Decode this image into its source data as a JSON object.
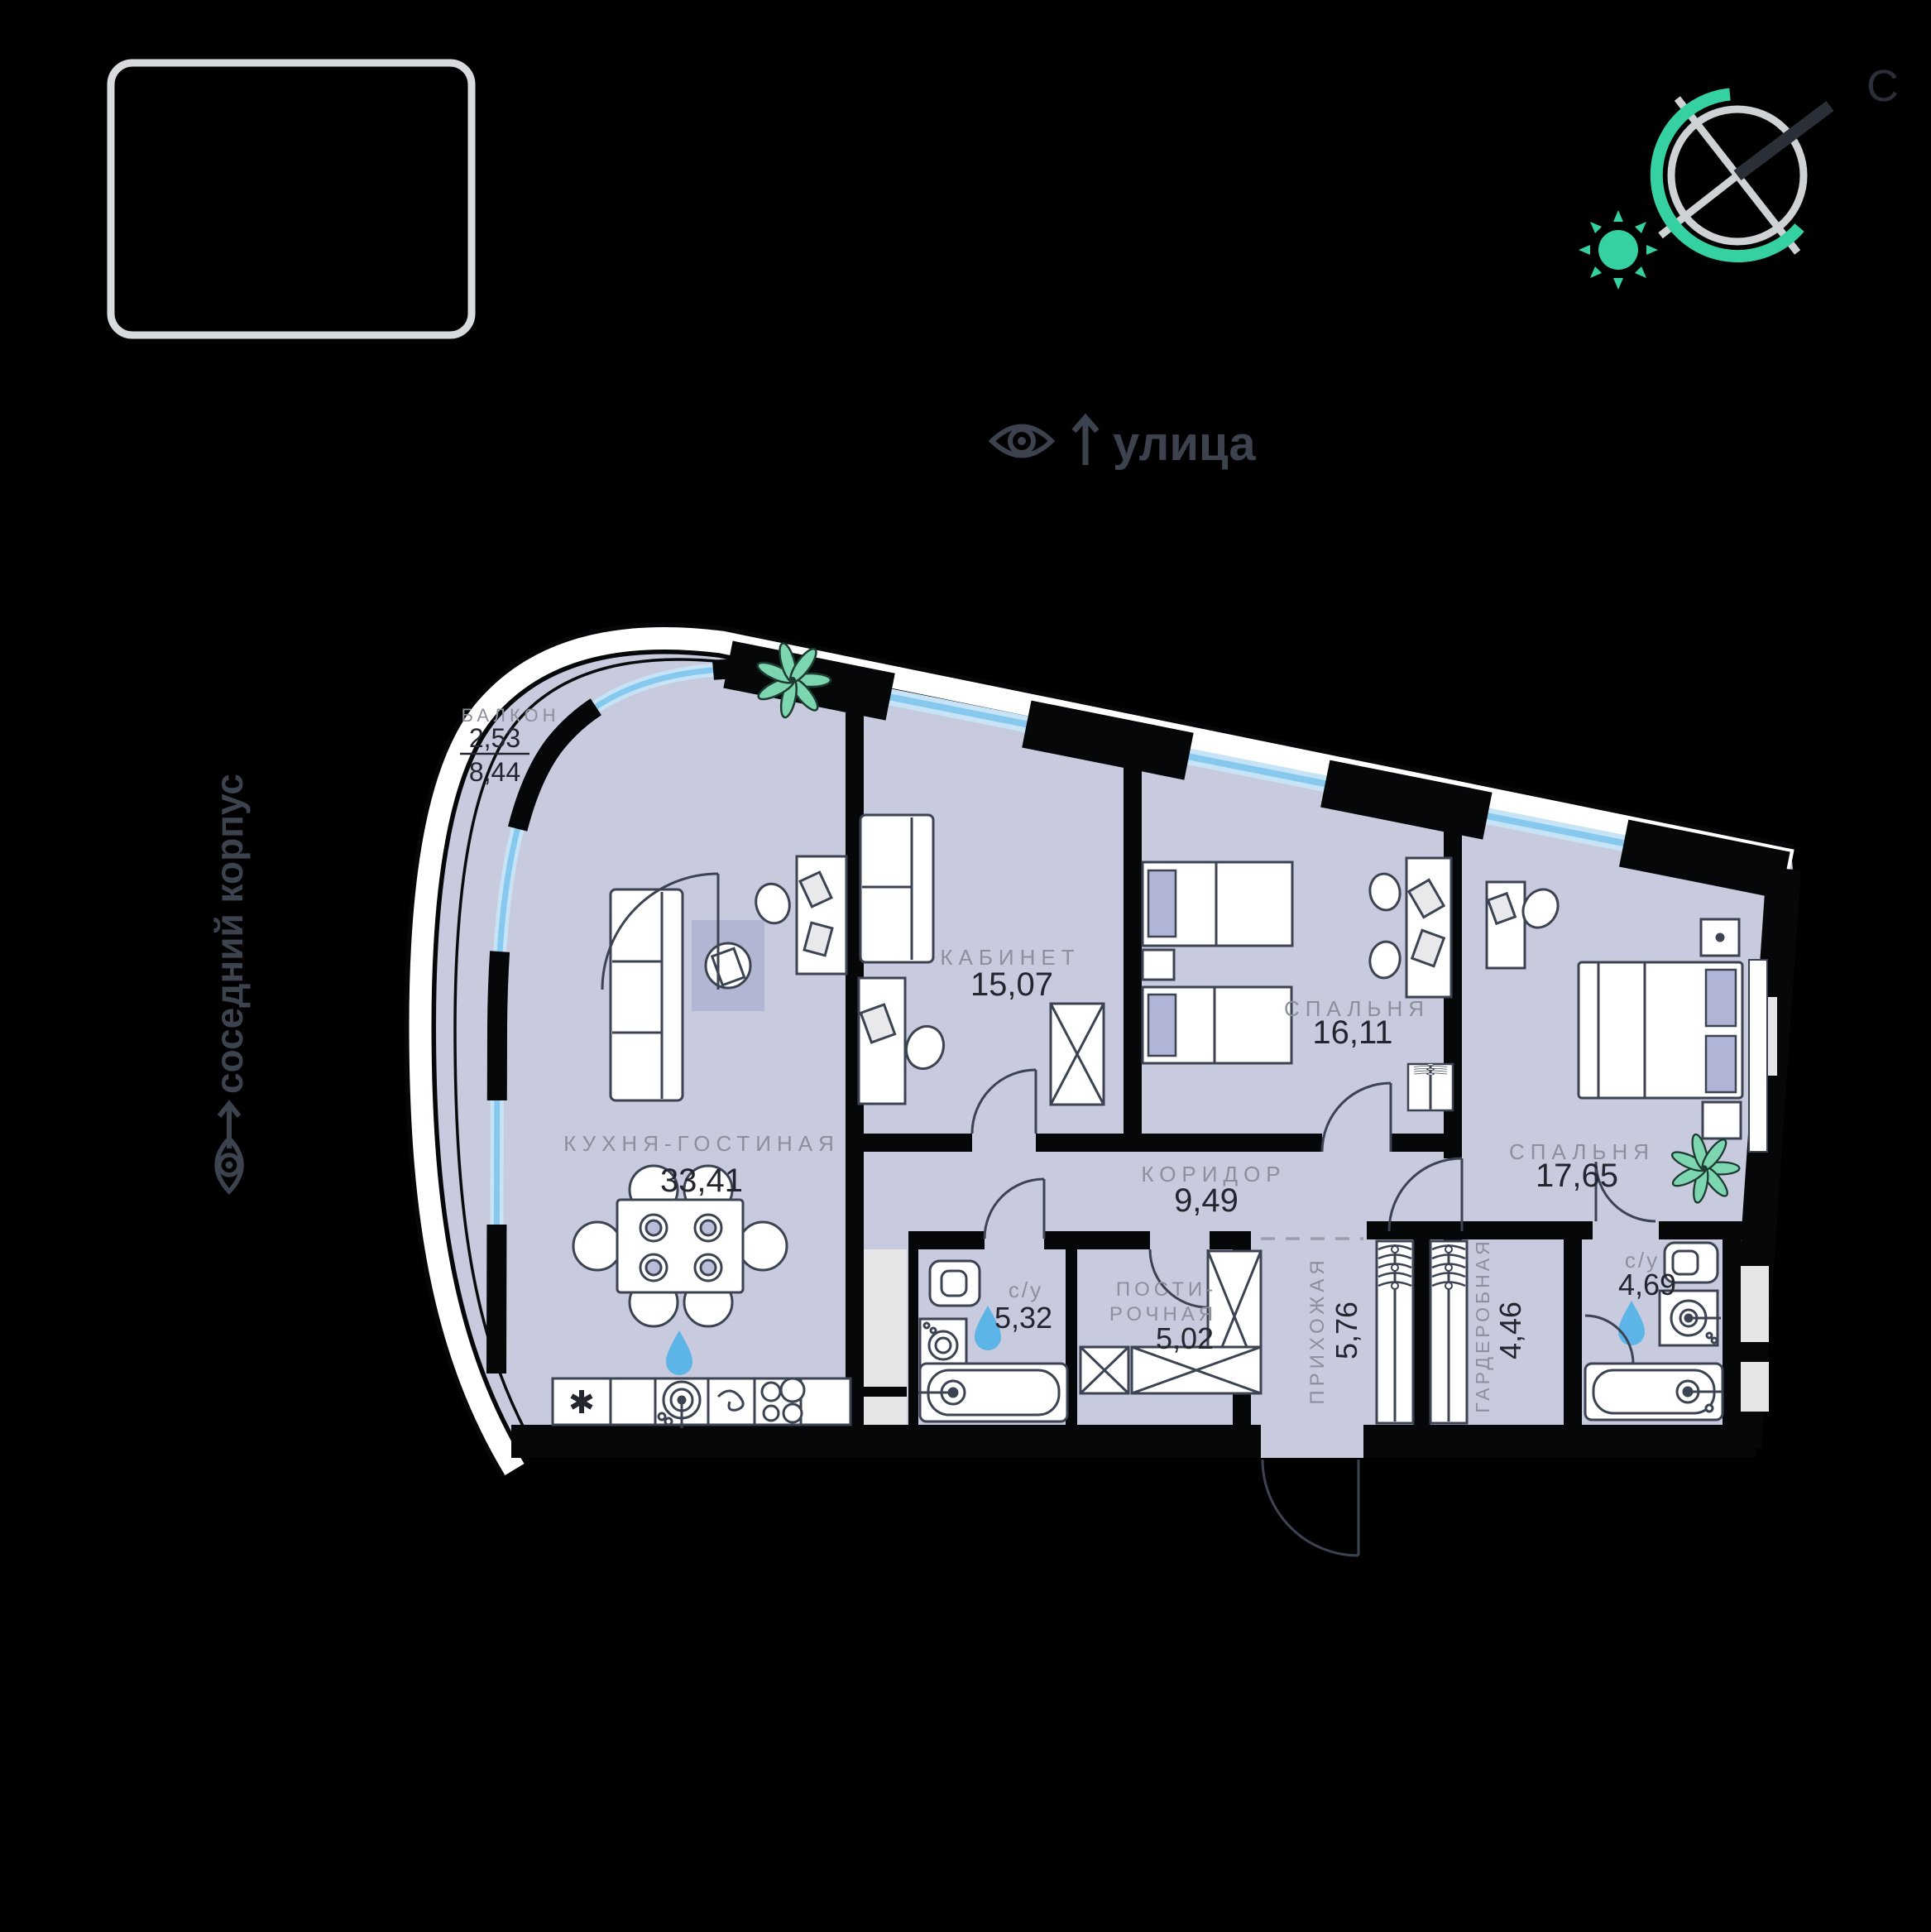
{
  "compass": {
    "north_label": "С"
  },
  "annotations": {
    "street": "улица",
    "neighbor": "соседний корпус"
  },
  "rooms": [
    {
      "id": "balcony",
      "name": "БАЛКОН",
      "area_upper": "2,53",
      "area_lower": "8,44"
    },
    {
      "id": "kitchen-living",
      "name": "КУХНЯ-ГОСТИНАЯ",
      "area": "33,41"
    },
    {
      "id": "office",
      "name": "КАБИНЕТ",
      "area": "15,07"
    },
    {
      "id": "bedroom-1",
      "name": "СПАЛЬНЯ",
      "area": "16,11"
    },
    {
      "id": "bedroom-2",
      "name": "СПАЛЬНЯ",
      "area": "17,65"
    },
    {
      "id": "corridor",
      "name": "КОРИДОР",
      "area": "9,49"
    },
    {
      "id": "bathroom-1",
      "name": "с/у",
      "area": "5,32"
    },
    {
      "id": "laundry",
      "name_line1": "ПОСТИ-",
      "name_line2": "РОЧНАЯ",
      "area": "5,02"
    },
    {
      "id": "hallway",
      "name": "ПРИХОЖАЯ",
      "area": "5,76"
    },
    {
      "id": "wardrobe",
      "name": "ГАРДЕРОБНАЯ",
      "area": "4,46"
    },
    {
      "id": "bathroom-2",
      "name": "с/у",
      "area": "4,69"
    }
  ],
  "colors": {
    "background": "#000000",
    "floor": "#c8cade",
    "rug": "#b3b6d2",
    "wall": "#060708",
    "glazing_core": "#86c8ee",
    "glazing_light": "#c7e4f7",
    "water_drop": "#5cb5e6",
    "accent_teal": "#35d1a2",
    "label_gray": "#8b909c",
    "number_dark": "#23262e",
    "badge_border": "#d8dbdd"
  }
}
